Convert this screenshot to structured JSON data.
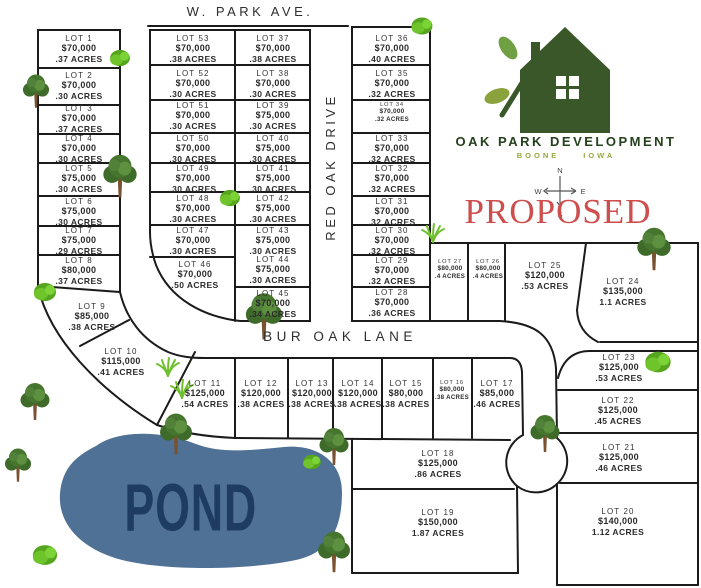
{
  "streets": {
    "w_park_ave": "W. PARK AVE.",
    "red_oak_drive": "RED OAK DRIVE",
    "bur_oak_lane": "BUR OAK LANE"
  },
  "logo": {
    "name": "OAK PARK DEVELOPMENT",
    "city": "BOONE",
    "state": "IOWA"
  },
  "status_label": "PROPOSED",
  "pond_label": "POND",
  "compass": {
    "n": "N",
    "e": "E",
    "s": "S",
    "w": "W"
  },
  "colors": {
    "logo_green": "#3a5729",
    "logo_olive": "#8aa23c",
    "proposed_red": "#ce4d4d",
    "pond_fill": "#4e7195",
    "pond_text": "#1e3c62",
    "line_black": "#1b1b1b"
  },
  "lots": [
    {
      "name": "LOT 1",
      "price": "$70,000",
      "acres": ".37 ACRES"
    },
    {
      "name": "LOT 2",
      "price": "$70,000",
      "acres": ".30 ACRES"
    },
    {
      "name": "LOT 3",
      "price": "$70,000",
      "acres": ".37 ACRES"
    },
    {
      "name": "LOT 4",
      "price": "$70,000",
      "acres": ".30 ACRES"
    },
    {
      "name": "LOT 5",
      "price": "$75,000",
      "acres": ".30 ACRES"
    },
    {
      "name": "LOT 6",
      "price": "$75,000",
      "acres": ".30 ACRES"
    },
    {
      "name": "LOT 7",
      "price": "$75,000",
      "acres": ".29 ACRES"
    },
    {
      "name": "LOT 8",
      "price": "$80,000",
      "acres": ".37 ACRES"
    },
    {
      "name": "LOT 9",
      "price": "$85,000",
      "acres": ".38 ACRES"
    },
    {
      "name": "LOT 10",
      "price": "$115,000",
      "acres": ".41 ACRES"
    },
    {
      "name": "LOT 11",
      "price": "$125,000",
      "acres": ".54 ACRES"
    },
    {
      "name": "LOT 12",
      "price": "$120,000",
      "acres": ".38 ACRES"
    },
    {
      "name": "LOT 13",
      "price": "$120,000",
      "acres": ".38 ACRES"
    },
    {
      "name": "LOT 14",
      "price": "$120,000",
      "acres": ".38 ACRES"
    },
    {
      "name": "LOT 15",
      "price": "$80,000",
      "acres": ".38 ACRES"
    },
    {
      "name": "LOT 16",
      "price": "$80,000",
      "acres": ".38 ACRES"
    },
    {
      "name": "LOT 17",
      "price": "$85,000",
      "acres": ".46 ACRES"
    },
    {
      "name": "LOT 18",
      "price": "$125,000",
      "acres": ".86 ACRES"
    },
    {
      "name": "LOT 19",
      "price": "$150,000",
      "acres": "1.87 ACRES"
    },
    {
      "name": "LOT 20",
      "price": "$140,000",
      "acres": "1.12 ACRES"
    },
    {
      "name": "LOT 21",
      "price": "$125,000",
      "acres": ".46 ACRES"
    },
    {
      "name": "LOT 22",
      "price": "$125,000",
      "acres": ".45 ACRES"
    },
    {
      "name": "LOT 23",
      "price": "$125,000",
      "acres": ".53 ACRES"
    },
    {
      "name": "LOT 24",
      "price": "$135,000",
      "acres": "1.1 ACRES"
    },
    {
      "name": "LOT 25",
      "price": "$120,000",
      "acres": ".53 ACRES"
    },
    {
      "name": "LOT 26",
      "price": "$80,000",
      "acres": ".4 ACRES"
    },
    {
      "name": "LOT 27",
      "price": "$80,000",
      "acres": ".4 ACRES"
    },
    {
      "name": "LOT 28",
      "price": "$70,000",
      "acres": ".36 ACRES"
    },
    {
      "name": "LOT 29",
      "price": "$70,000",
      "acres": ".32 ACRES"
    },
    {
      "name": "LOT 30",
      "price": "$70,000",
      "acres": ".32 ACRES"
    },
    {
      "name": "LOT 31",
      "price": "$70,000",
      "acres": ".32 ACRES"
    },
    {
      "name": "LOT 32",
      "price": "$70,000",
      "acres": ".32 ACRES"
    },
    {
      "name": "LOT 33",
      "price": "$70,000",
      "acres": ".32 ACRES"
    },
    {
      "name": "LOT 34",
      "price": "$70,000",
      "acres": ".32 ACRES"
    },
    {
      "name": "LOT 35",
      "price": "$70,000",
      "acres": ".32 ACRES"
    },
    {
      "name": "LOT 36",
      "price": "$70,000",
      "acres": ".40 ACRES"
    },
    {
      "name": "LOT 37",
      "price": "$70,000",
      "acres": ".38 ACRES"
    },
    {
      "name": "LOT 38",
      "price": "$70,000",
      "acres": ".30 ACRES"
    },
    {
      "name": "LOT 39",
      "price": "$75,000",
      "acres": ".30 ACRES"
    },
    {
      "name": "LOT 40",
      "price": "$75,000",
      "acres": ".30 ACRES"
    },
    {
      "name": "LOT 41",
      "price": "$75,000",
      "acres": ".30 ACRES"
    },
    {
      "name": "LOT 42",
      "price": "$75,000",
      "acres": ".30 ACRES"
    },
    {
      "name": "LOT 43",
      "price": "$75,000",
      "acres": ".30 ACRES"
    },
    {
      "name": "LOT 44",
      "price": "$75,000",
      "acres": ".30 ACRES"
    },
    {
      "name": "LOT 45",
      "price": "$70,000",
      "acres": ".34 ACRES"
    },
    {
      "name": "LOT 46",
      "price": "$70,000",
      "acres": ".50 ACRES"
    },
    {
      "name": "LOT 47",
      "price": "$70,000",
      "acres": ".30 ACRES"
    },
    {
      "name": "LOT 48",
      "price": "$70,000",
      "acres": ".30 ACRES"
    },
    {
      "name": "LOT 49",
      "price": "$70,000",
      "acres": ".30 ACRES"
    },
    {
      "name": "LOT 50",
      "price": "$70,000",
      "acres": ".30 ACRES"
    },
    {
      "name": "LOT 51",
      "price": "$70,000",
      "acres": ".30 ACRES"
    },
    {
      "name": "LOT 52",
      "price": "$70,000",
      "acres": ".30 ACRES"
    },
    {
      "name": "LOT 53",
      "price": "$70,000",
      "acres": ".38 ACRES"
    }
  ]
}
